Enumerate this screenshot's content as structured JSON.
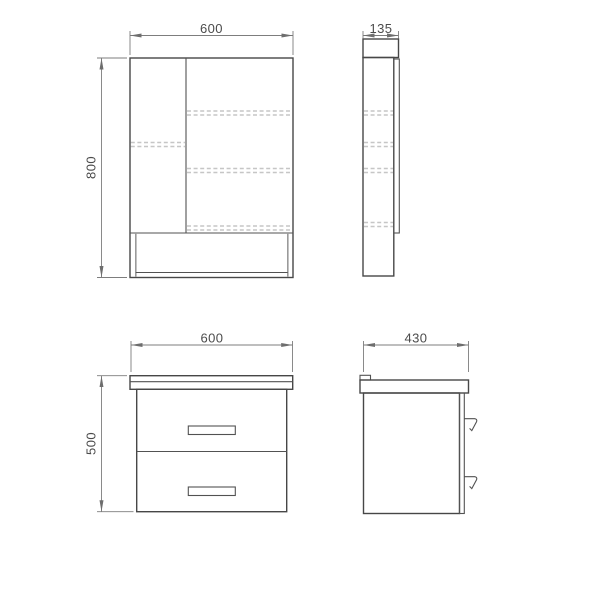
{
  "drawing": {
    "background": "#ffffff",
    "colors": {
      "outline": "#474747",
      "inner_line": "#525252",
      "panel_gray": "#9a9a9a",
      "hidden_line": "#c6c6c6",
      "dimension": "#7d7d7d",
      "text": "#4b4b4b"
    },
    "views": {
      "mirror_cabinet_front": {
        "width_label": "600",
        "height_label": "800"
      },
      "mirror_cabinet_side": {
        "depth_label": "135"
      },
      "vanity_front": {
        "width_label": "600",
        "height_label": "500"
      },
      "vanity_side": {
        "depth_label": "430"
      }
    }
  }
}
